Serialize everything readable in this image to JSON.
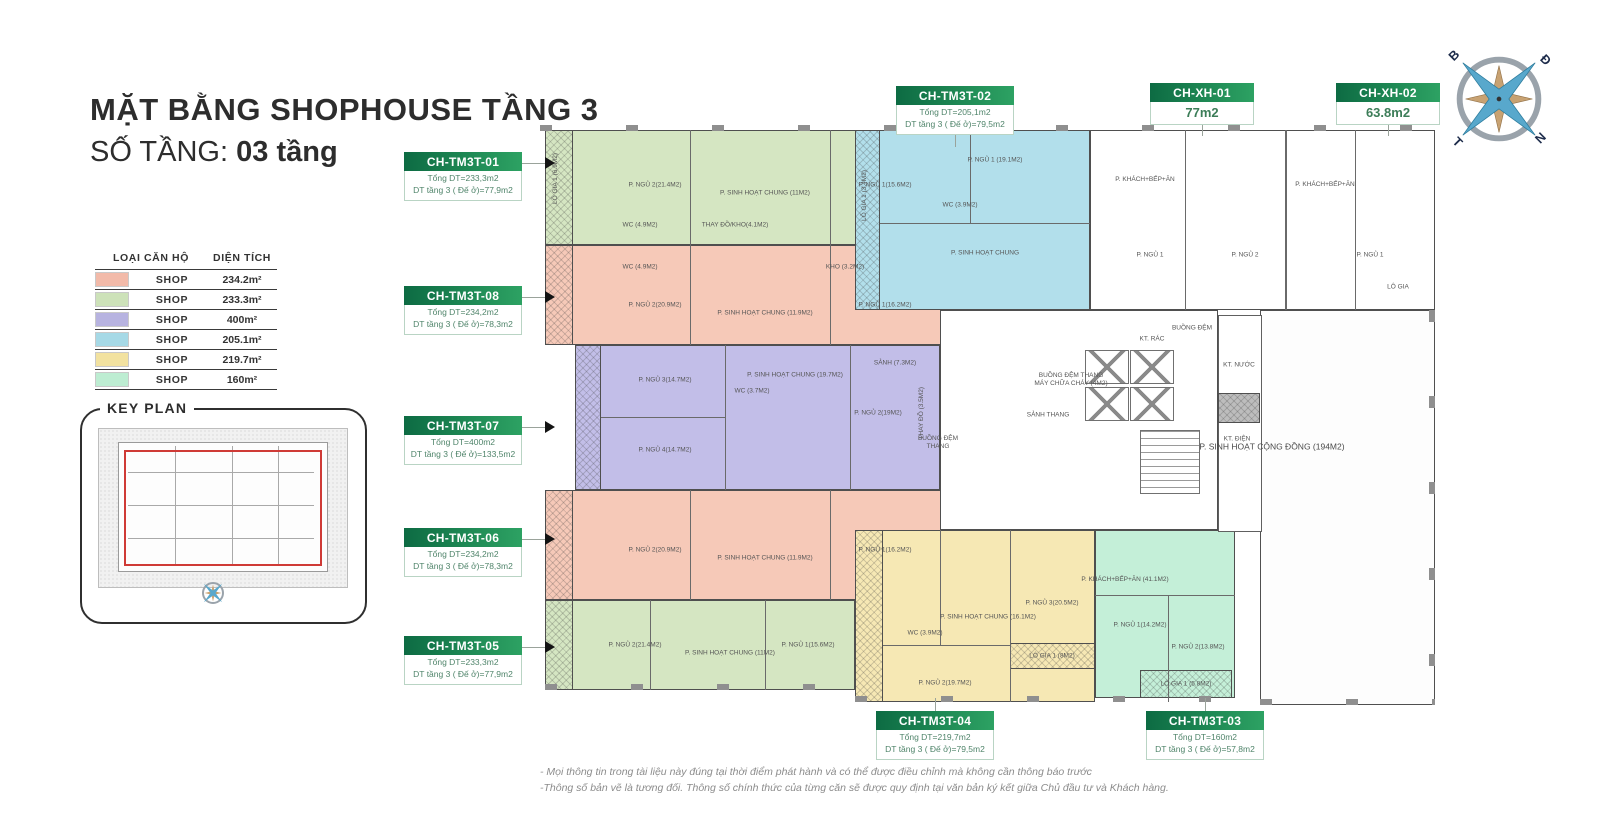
{
  "title": {
    "line1": "MẶT BẰNG SHOPHOUSE TẦNG 3",
    "line2_label": "SỐ TẦNG:",
    "line2_value": "03 tầng"
  },
  "legend": {
    "headers": [
      "LOẠI CĂN HỘ",
      "DIỆN TÍCH"
    ],
    "rows": [
      {
        "color": "#f2baa9",
        "type": "SHOP",
        "area": "234.2m²"
      },
      {
        "color": "#cde2b9",
        "type": "SHOP",
        "area": "233.3m²"
      },
      {
        "color": "#b7b3e0",
        "type": "SHOP",
        "area": "400m²"
      },
      {
        "color": "#a6d9e6",
        "type": "SHOP",
        "area": "205.1m²"
      },
      {
        "color": "#f2e2a0",
        "type": "SHOP",
        "area": "219.7m²"
      },
      {
        "color": "#bdedd2",
        "type": "SHOP",
        "area": "160m²"
      }
    ]
  },
  "key_plan": {
    "label": "KEY PLAN"
  },
  "compass": {
    "north": "B",
    "east": "Đ",
    "south": "N",
    "west": "T"
  },
  "units": [
    {
      "id": "CH-TM3T-01",
      "total": "Tổng DT=233,3m2",
      "floor3": "DT tầng 3 ( Đế ở)=77,9m2"
    },
    {
      "id": "CH-TM3T-02",
      "total": "Tổng DT=205,1m2",
      "floor3": "DT tầng 3 ( Đế ở)=79,5m2"
    },
    {
      "id": "CH-XH-01",
      "area": "77m2"
    },
    {
      "id": "CH-XH-02",
      "area": "63.8m2"
    },
    {
      "id": "CH-TM3T-08",
      "total": "Tổng DT=234,2m2",
      "floor3": "DT tầng 3 ( Đế ở)=78,3m2"
    },
    {
      "id": "CH-TM3T-07",
      "total": "Tổng DT=400m2",
      "floor3": "DT tầng 3 ( Đế ở)=133,5m2"
    },
    {
      "id": "CH-TM3T-06",
      "total": "Tổng DT=234,2m2",
      "floor3": "DT tầng 3 ( Đế ở)=78,3m2"
    },
    {
      "id": "CH-TM3T-05",
      "total": "Tổng DT=233,3m2",
      "floor3": "DT tầng 3 ( Đế ở)=77,9m2"
    },
    {
      "id": "CH-TM3T-04",
      "total": "Tổng DT=219,7m2",
      "floor3": "DT tầng 3 ( Đế ở)=79,5m2"
    },
    {
      "id": "CH-TM3T-03",
      "total": "Tổng DT=160m2",
      "floor3": "DT tầng 3 ( Đế ở)=57,8m2"
    }
  ],
  "plan_labels": [
    "P. NGỦ 2(21.4M2)",
    "P. SINH HOẠT CHUNG (11M2)",
    "P. NGỦ 1(15.6M2)",
    "WC (4.9M2)",
    "THAY ĐỒ/KHO(4.1M2)",
    "LÔ GIA 1 (6.9M2)",
    "P. NGỦ 2(20.9M2)",
    "P. SINH HOẠT CHUNG (11.9M2)",
    "P. NGỦ 1(16.2M2)",
    "WC (4.9M2)",
    "KHO (3.2M2)",
    "P. NGỦ 3(14.7M2)",
    "P. SINH HOẠT CHUNG (19.7M2)",
    "P. NGỦ 2(19M2)",
    "P. NGỦ 4(14.7M2)",
    "WC (3.7M2)",
    "SẢNH (7.3M2)",
    "THAY ĐỒ (3.5M2)",
    "P. NGỦ 2(20.9M2)",
    "P. SINH HOẠT CHUNG (11.9M2)",
    "P. NGỦ 1(16.2M2)",
    "P. NGỦ 2(21.4M2)",
    "P. SINH HOẠT CHUNG (11M2)",
    "P. NGỦ 1(15.6M2)",
    "P. NGỦ 1 (19.1M2)",
    "P. SINH HOẠT CHUNG",
    "WC (3.9M2)",
    "LÔ GIA 1 (3.4M2)",
    "SẢNH THANG",
    "KT. RÁC",
    "BUỒNG ĐỆM",
    "KT. NƯỚC",
    "KT. ĐIỆN",
    "BUỒNG ĐỆM THANG MÁY CHỮA CHÁY (4M2)",
    "BUỒNG ĐỆM THANG",
    "P. SINH HOẠT CỘNG ĐỒNG (194M2)",
    "P. SINH HOẠT CHUNG (16.1M2)",
    "P. NGỦ 3(20.5M2)",
    "P. NGỦ 2(19.7M2)",
    "WC (3.9M2)",
    "LÔ GIA 1 (8M2)",
    "P. KHÁCH+BẾP+ĂN (41.1M2)",
    "P. NGỦ 1(14.2M2)",
    "P. NGỦ 2(13.8M2)",
    "LÔ GIA 1 (5.8M2)",
    "P. KHÁCH+BẾP+ĂN",
    "P. NGỦ 1",
    "P. NGỦ 2",
    "P. KHÁCH+BẾP+ĂN",
    "P. NGỦ 1",
    "LÔ GIA"
  ],
  "footnotes": [
    "- Mọi thông tin trong tài liệu này đúng tại thời điểm phát hành và có thể được điều chỉnh mà không cần thông báo trước",
    "-Thông số bản vẽ là tương đối. Thông số chính thức của từng căn sẽ được quy định tại văn bản ký kết giữa Chủ đầu tư và Khách hàng."
  ],
  "colors": {
    "accent_green_dark": "#0d6b43",
    "accent_green_light": "#2da263",
    "keyplan_red": "#cf3a36",
    "compass_blue": "#58a8cc",
    "compass_tan": "#c8a272"
  }
}
